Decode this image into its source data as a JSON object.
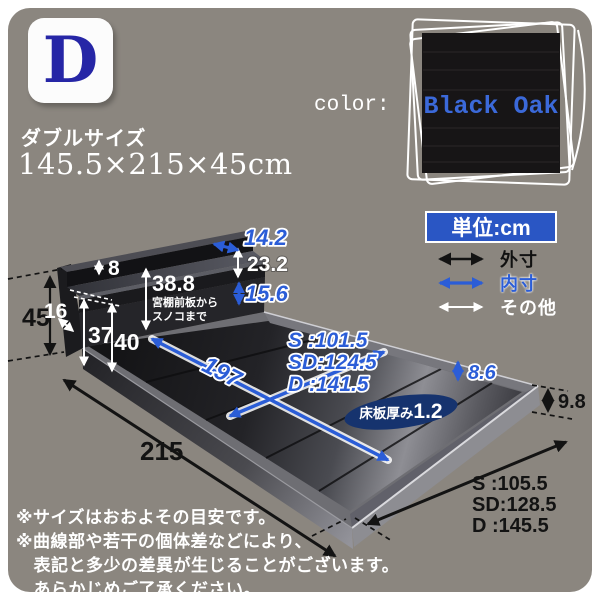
{
  "header": {
    "letter": "D",
    "size_name": "ダブルサイズ",
    "size_dims": "145.5×215×45cm",
    "color_label": "color:",
    "color_name": "Black Oak"
  },
  "legend": {
    "unit_label": "単位:cm",
    "items": [
      {
        "label": "外寸",
        "color": "#131313"
      },
      {
        "label": "内寸",
        "color": "#2b5dd7"
      },
      {
        "label": "その他",
        "color": "#ffffff"
      }
    ]
  },
  "dims": {
    "outer_height": "45",
    "outer_length": "215",
    "outer_width": [
      "S :105.5",
      "SD:128.5",
      "D :145.5"
    ],
    "frame_height": "9.8",
    "inner_length": "197",
    "inner_width": [
      "S :101.5",
      "SD:124.5",
      "D :141.5"
    ],
    "shelf_top_depth": "14.2",
    "shelf_drop": "23.2",
    "opening_height": "15.6",
    "frame_inner_depth": "8.6",
    "top_board_thickness": "8",
    "shelf_depth": "16",
    "height_37": "37",
    "height_40": "40",
    "shelf_to_slats": "38.8",
    "shelf_to_slats_note1": "宮棚前板から",
    "shelf_to_slats_note2": "スノコまで",
    "slat_thickness_label": "床板厚み",
    "slat_thickness_value": "1.2"
  },
  "footnotes": [
    "※サイズはおおよその目安です。",
    "※曲線部や若干の個体差などにより、",
    "　表記と多少の差異が生じることがございます。",
    "　あらかじめご了承ください。"
  ],
  "colors": {
    "panel_gray": "#8b867f",
    "accent_blue": "#2b5dd7",
    "unit_box_blue": "#2a56c4",
    "badge_letter_blue": "#2626a6",
    "swatch_black": "#171516",
    "ellipse_navy": "#16336e"
  }
}
